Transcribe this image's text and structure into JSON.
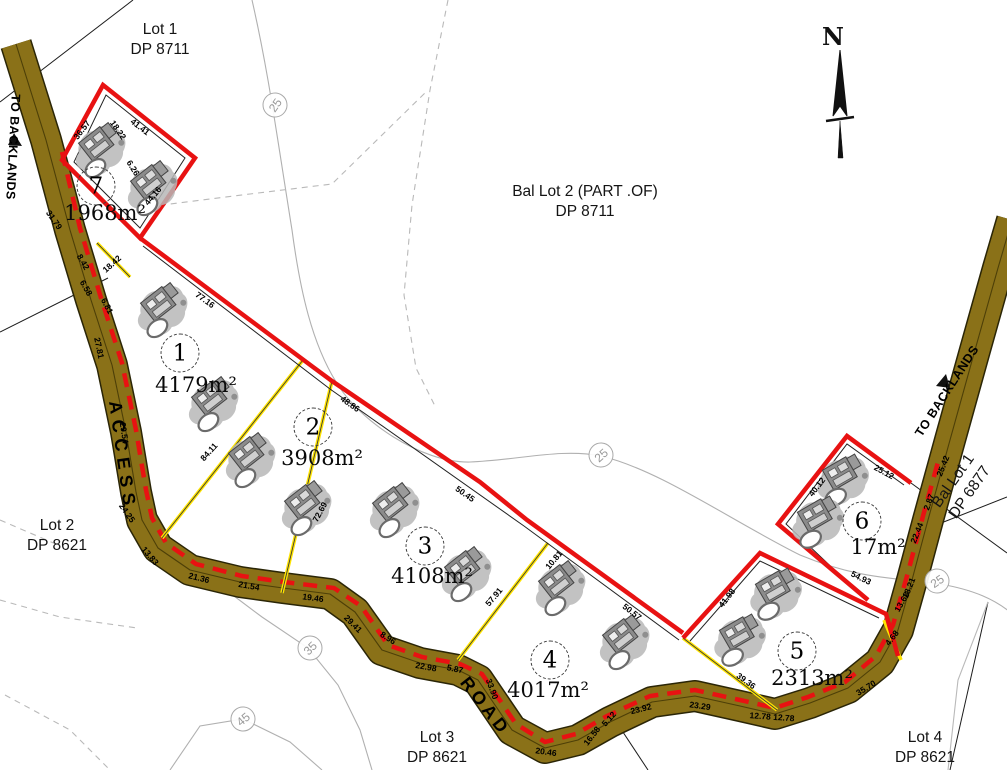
{
  "north": {
    "label": "N"
  },
  "road": {
    "access_label": "ACCESS",
    "road_label": "ROAD",
    "to_backlands": "TO BACKLANDS"
  },
  "colors": {
    "road_fill": "#8a7118",
    "road_edge": "#2a2506",
    "boundary_red": "#e81212",
    "divider_yellow": "#ffe400",
    "contour_gray": "#b0b0b0"
  },
  "parcels": [
    {
      "l1": "Lot 1",
      "l2": "DP 8711",
      "x": 160,
      "y": 40,
      "r": 0
    },
    {
      "l1": "Bal Lot 2 (PART .OF)",
      "l2": "DP 8711",
      "x": 585,
      "y": 202,
      "r": 0
    },
    {
      "l1": "Lot 2",
      "l2": "DP 8621",
      "x": 57,
      "y": 536,
      "r": 0
    },
    {
      "l1": "Lot 3",
      "l2": "DP 8621",
      "x": 437,
      "y": 748,
      "r": 0
    },
    {
      "l1": "Lot 4",
      "l2": "DP 8621",
      "x": 925,
      "y": 748,
      "r": 0
    },
    {
      "l1": "Bal Lot 1",
      "l2": "DP 6877",
      "x": 962,
      "y": 487,
      "r": -55
    }
  ],
  "lots": [
    {
      "number": "7",
      "area": "1968m²",
      "cx": 96,
      "cy": 186,
      "ax": 105,
      "ay": 213
    },
    {
      "number": "1",
      "area": "4179m²",
      "cx": 180,
      "cy": 353,
      "ax": 196,
      "ay": 385
    },
    {
      "number": "2",
      "area": "3908m²",
      "cx": 313,
      "cy": 427,
      "ax": 322,
      "ay": 458
    },
    {
      "number": "3",
      "area": "4108m²",
      "cx": 425,
      "cy": 546,
      "ax": 432,
      "ay": 576
    },
    {
      "number": "4",
      "area": "4017m²",
      "cx": 550,
      "cy": 660,
      "ax": 548,
      "ay": 690
    },
    {
      "number": "5",
      "area": "2313m²",
      "cx": 797,
      "cy": 651,
      "ax": 812,
      "ay": 678
    },
    {
      "number": "6",
      "area": "17m²",
      "cx": 862,
      "cy": 521,
      "ax": 878,
      "ay": 547
    }
  ],
  "contour_labels": [
    {
      "t": "25",
      "x": 275,
      "y": 105,
      "r": -55
    },
    {
      "t": "25",
      "x": 601,
      "y": 455,
      "r": -42
    },
    {
      "t": "25",
      "x": 937,
      "y": 581,
      "r": -35
    },
    {
      "t": "35",
      "x": 310,
      "y": 648,
      "r": -45
    },
    {
      "t": "45",
      "x": 243,
      "y": 719,
      "r": -40
    }
  ],
  "dimensions": [
    {
      "t": "18.22",
      "x": 118,
      "y": 130,
      "r": 55
    },
    {
      "t": "6.26",
      "x": 133,
      "y": 168,
      "r": 58
    },
    {
      "t": "31.79",
      "x": 54,
      "y": 220,
      "r": 55
    },
    {
      "t": "8.42",
      "x": 83,
      "y": 262,
      "r": 60
    },
    {
      "t": "6.58",
      "x": 86,
      "y": 288,
      "r": 60
    },
    {
      "t": "6.81",
      "x": 107,
      "y": 306,
      "r": 62
    },
    {
      "t": "27.81",
      "x": 99,
      "y": 348,
      "r": 78
    },
    {
      "t": "29.54",
      "x": 124,
      "y": 433,
      "r": 82
    },
    {
      "t": "24.25",
      "x": 127,
      "y": 513,
      "r": 55
    },
    {
      "t": "13.83",
      "x": 150,
      "y": 556,
      "r": 50
    },
    {
      "t": "21.36",
      "x": 199,
      "y": 578,
      "r": 14
    },
    {
      "t": "21.54",
      "x": 249,
      "y": 586,
      "r": 10
    },
    {
      "t": "19.46",
      "x": 313,
      "y": 598,
      "r": 8
    },
    {
      "t": "29.41",
      "x": 353,
      "y": 624,
      "r": 45
    },
    {
      "t": "8.96",
      "x": 388,
      "y": 638,
      "r": 32
    },
    {
      "t": "22.98",
      "x": 426,
      "y": 667,
      "r": 10
    },
    {
      "t": "5.87",
      "x": 455,
      "y": 669,
      "r": 12
    },
    {
      "t": "33.90",
      "x": 492,
      "y": 689,
      "r": 70
    },
    {
      "t": "20.46",
      "x": 546,
      "y": 752,
      "r": 8
    },
    {
      "t": "16.58",
      "x": 592,
      "y": 736,
      "r": -52
    },
    {
      "t": "5.12",
      "x": 609,
      "y": 719,
      "r": -48
    },
    {
      "t": "23.92",
      "x": 641,
      "y": 709,
      "r": -14
    },
    {
      "t": "23.29",
      "x": 700,
      "y": 706,
      "r": 8
    },
    {
      "t": "12.78 12.78",
      "x": 772,
      "y": 717,
      "r": 4
    },
    {
      "t": "35.70",
      "x": 866,
      "y": 688,
      "r": -32
    },
    {
      "t": "4.68",
      "x": 892,
      "y": 638,
      "r": -52
    },
    {
      "t": "13.68",
      "x": 902,
      "y": 602,
      "r": -60
    },
    {
      "t": "18.21",
      "x": 909,
      "y": 588,
      "r": -68
    },
    {
      "t": "22.44",
      "x": 917,
      "y": 533,
      "r": -68
    },
    {
      "t": "2.87",
      "x": 929,
      "y": 502,
      "r": -70
    },
    {
      "t": "25.42",
      "x": 943,
      "y": 466,
      "r": -68
    },
    {
      "t": "36.57",
      "x": 82,
      "y": 130,
      "r": -52
    },
    {
      "t": "41.41",
      "x": 140,
      "y": 127,
      "r": 38
    },
    {
      "t": "44.16",
      "x": 153,
      "y": 196,
      "r": -50
    },
    {
      "t": "18.42",
      "x": 112,
      "y": 264,
      "r": -42
    },
    {
      "t": "77.16",
      "x": 205,
      "y": 300,
      "r": 36
    },
    {
      "t": "84.11",
      "x": 209,
      "y": 452,
      "r": -48
    },
    {
      "t": "48.86",
      "x": 350,
      "y": 404,
      "r": 35
    },
    {
      "t": "72.69",
      "x": 320,
      "y": 512,
      "r": -62
    },
    {
      "t": "50.45",
      "x": 465,
      "y": 494,
      "r": 35
    },
    {
      "t": "57.91",
      "x": 494,
      "y": 597,
      "r": -50
    },
    {
      "t": "10.81",
      "x": 554,
      "y": 560,
      "r": -50
    },
    {
      "t": "50.57",
      "x": 632,
      "y": 612,
      "r": 38
    },
    {
      "t": "39.36",
      "x": 746,
      "y": 681,
      "r": 36
    },
    {
      "t": "41.98",
      "x": 727,
      "y": 598,
      "r": -52
    },
    {
      "t": "54.93",
      "x": 861,
      "y": 578,
      "r": 26
    },
    {
      "t": "25.12",
      "x": 884,
      "y": 472,
      "r": 28
    },
    {
      "t": "40.12",
      "x": 817,
      "y": 487,
      "r": -52
    }
  ]
}
